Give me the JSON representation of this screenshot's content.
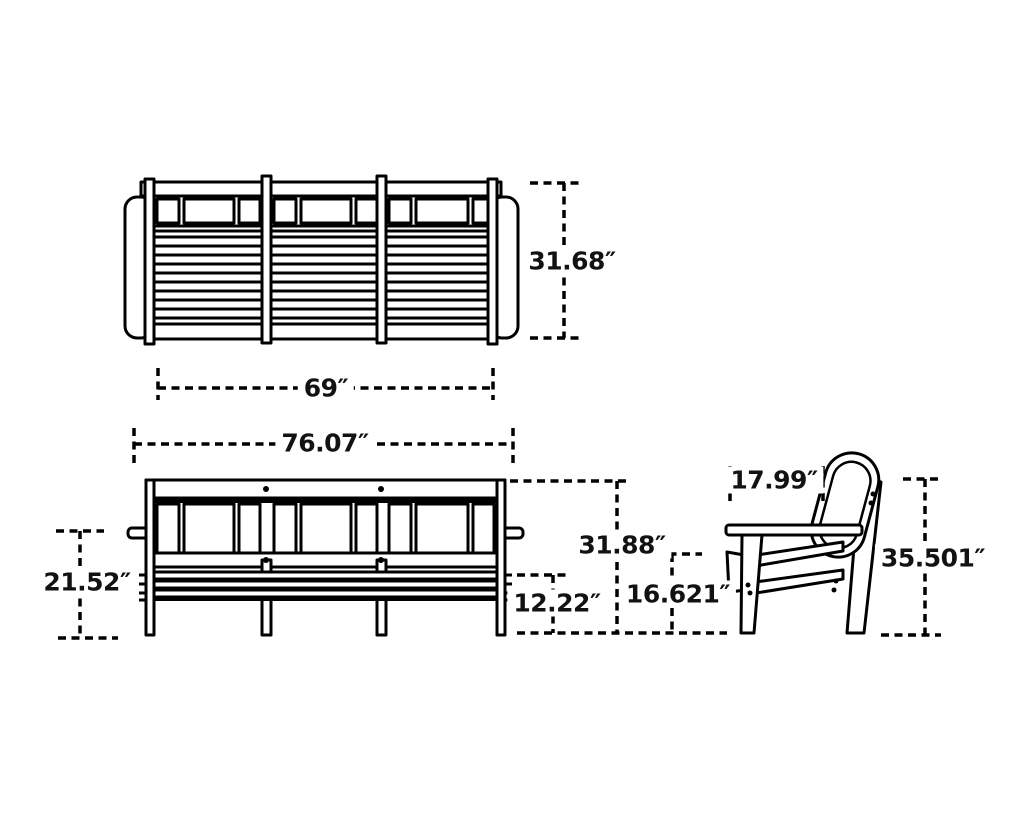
{
  "diagram": {
    "background": "#ffffff",
    "line_color": "#000000",
    "text_color": "#121212",
    "dimensions": {
      "sofa_back_height": "31.68″",
      "sofa_back_width": "69″",
      "sofa_overall_width": "76.07″",
      "sofa_arm_height": "21.52″",
      "sofa_overall_height": "31.88″",
      "sofa_seat_height": "12.22″",
      "sofa_back_rail_height": "16.621″",
      "chair_arm_depth": "17.99″",
      "chair_overall_height": "35.501″"
    }
  }
}
